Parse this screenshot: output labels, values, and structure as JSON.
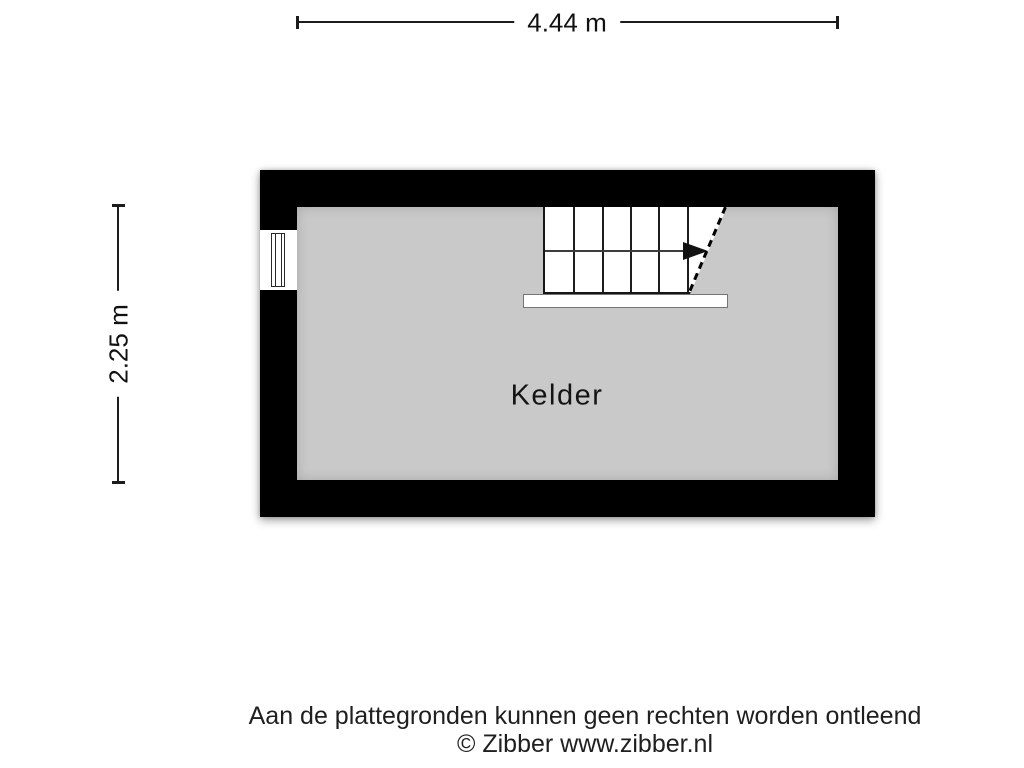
{
  "colors": {
    "background": "#ffffff",
    "wall": "#000000",
    "floor": "#c9c9c9",
    "dimension_line": "#1c1c1c"
  },
  "dimensions": {
    "width": {
      "label": "4.44 m"
    },
    "height": {
      "label": "2.25 m"
    }
  },
  "floorplan": {
    "room": {
      "label": "Kelder"
    },
    "features": {
      "window": "window-in-left-wall",
      "stairs": "staircase-with-direction-arrow"
    }
  },
  "footer": {
    "disclaimer": "Aan de plattegronden kunnen geen rechten worden ontleend",
    "credit": "© Zibber www.zibber.nl"
  }
}
